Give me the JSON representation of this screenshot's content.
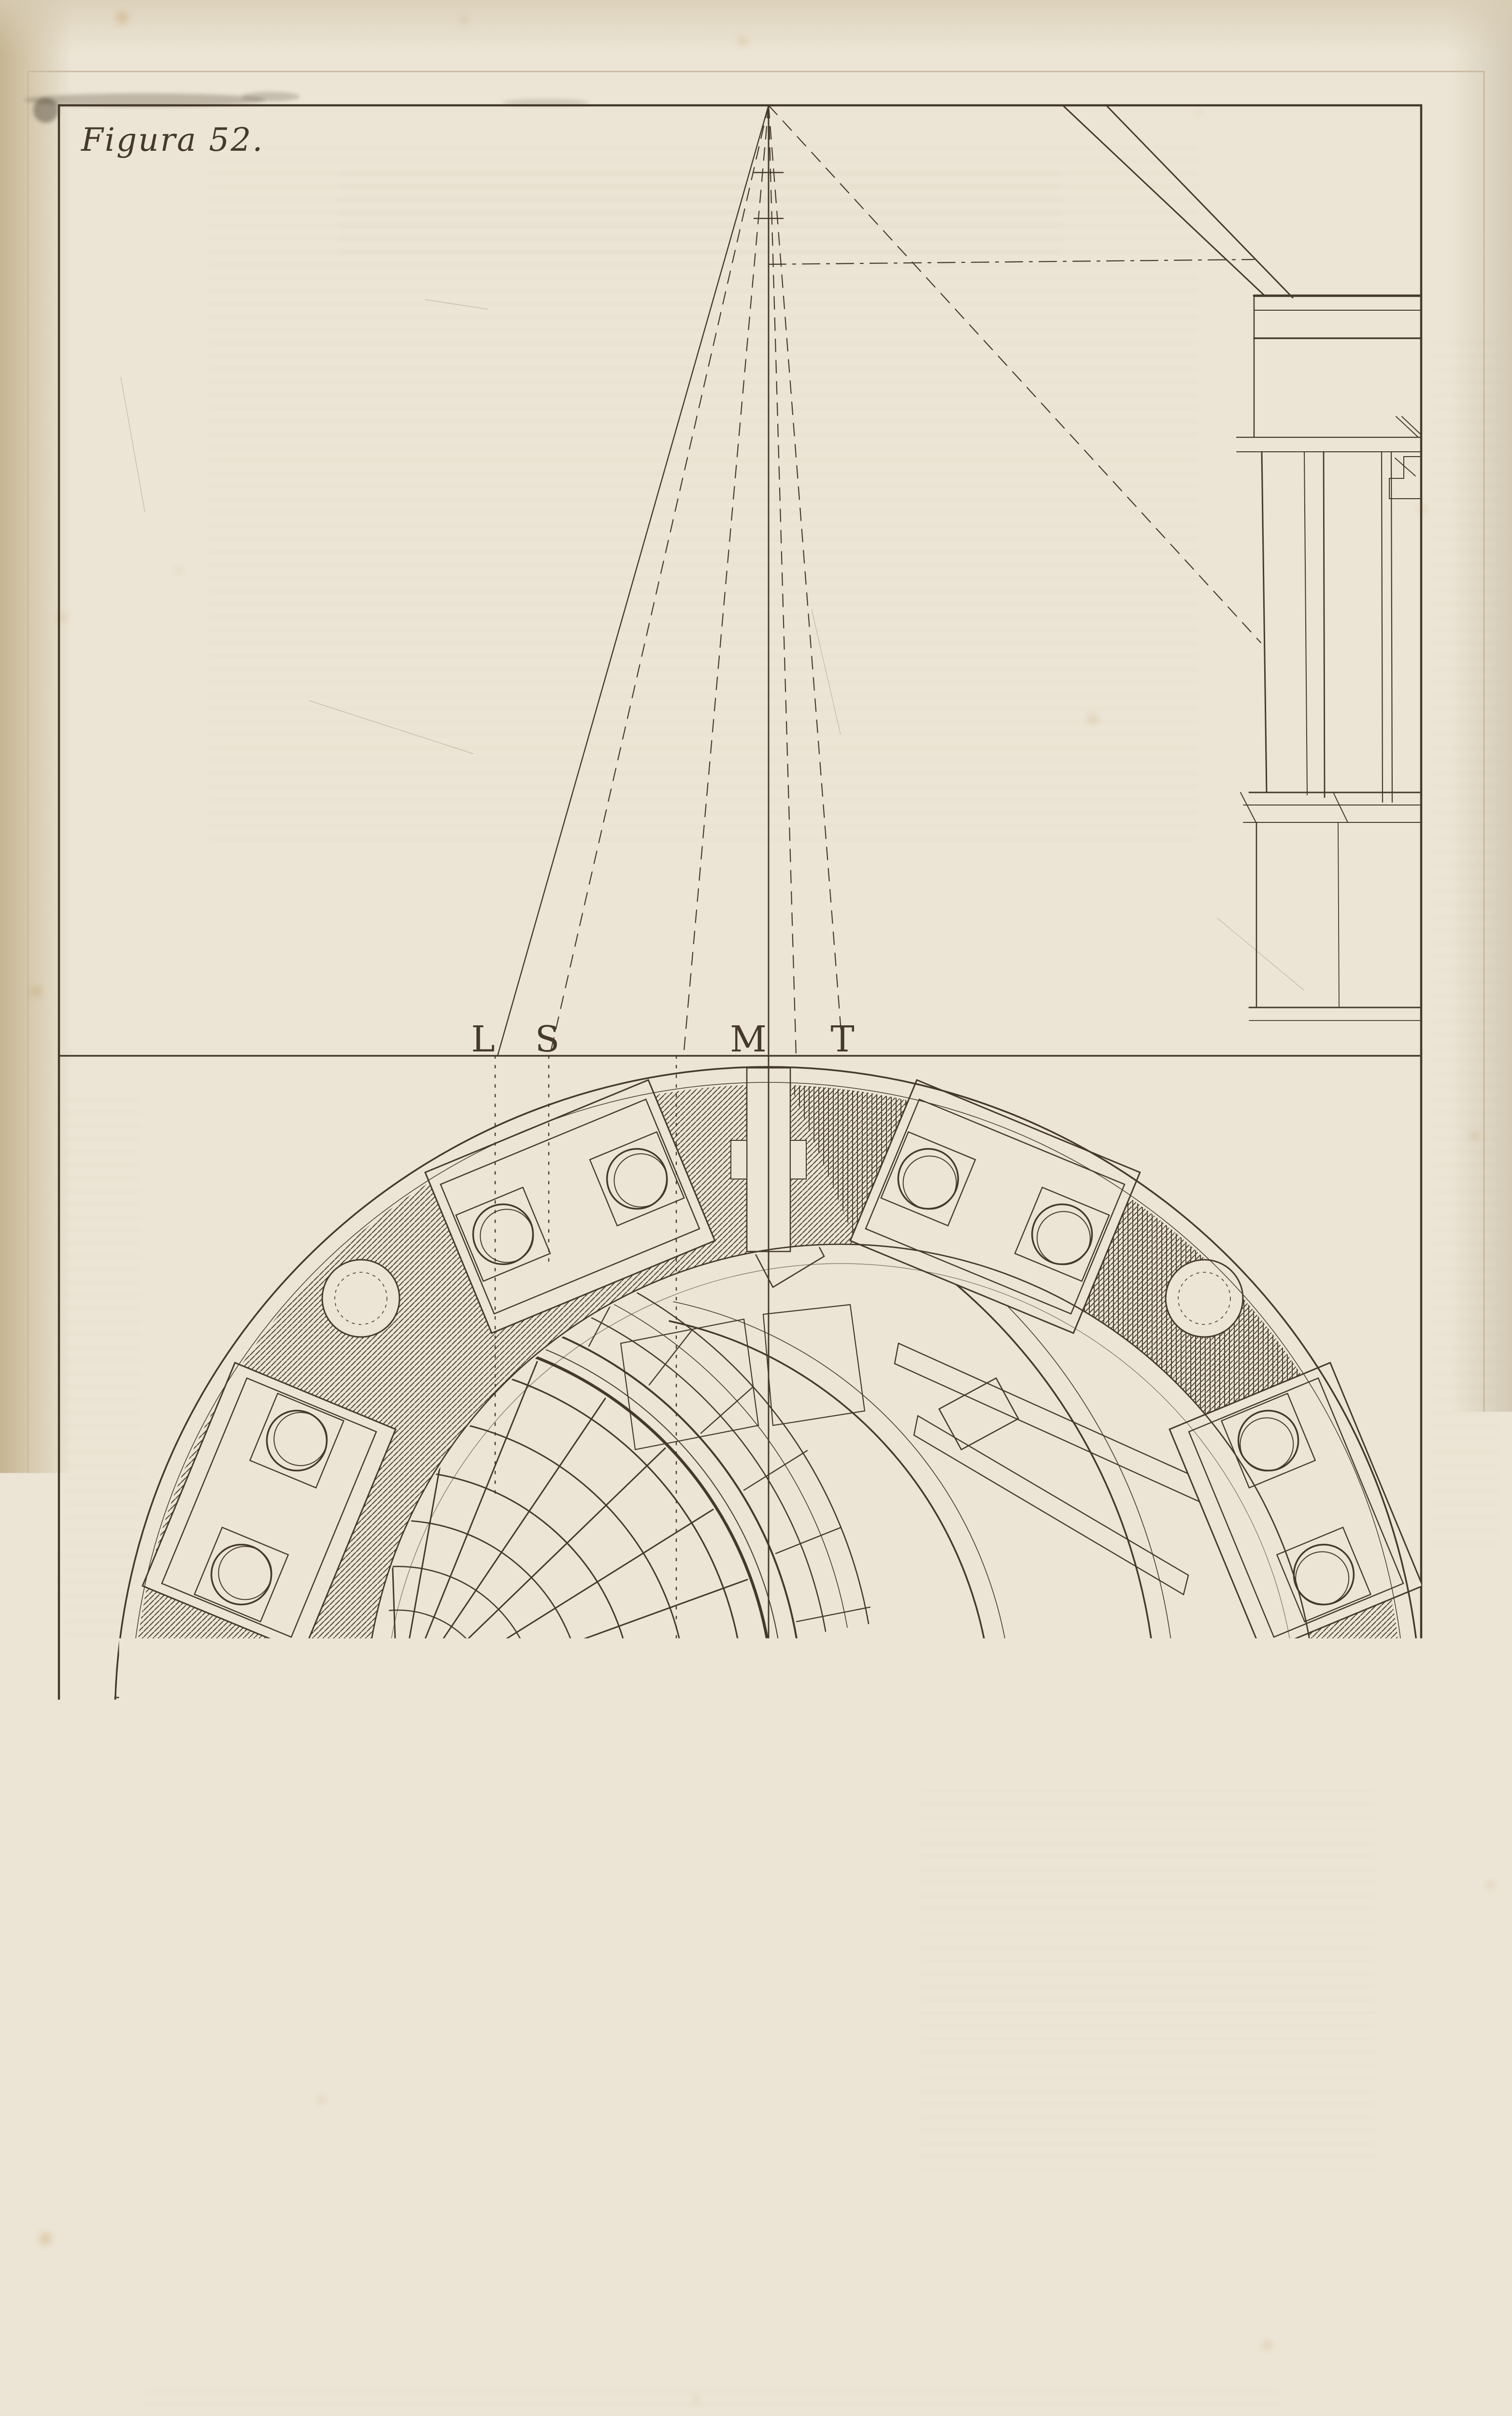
{
  "plate": {
    "figure_label": "Figura 52."
  },
  "point_labels": [
    {
      "char": "L"
    },
    {
      "char": "S"
    },
    {
      "char": "M"
    },
    {
      "char": "T"
    }
  ],
  "colors": {
    "paper": "#ece5d5",
    "paper_edge": "#c3b28e",
    "ink": "#44392b",
    "ink_soft": "#6c6151",
    "plate_mark": "#c7baa0",
    "stain": "#b9893f"
  }
}
